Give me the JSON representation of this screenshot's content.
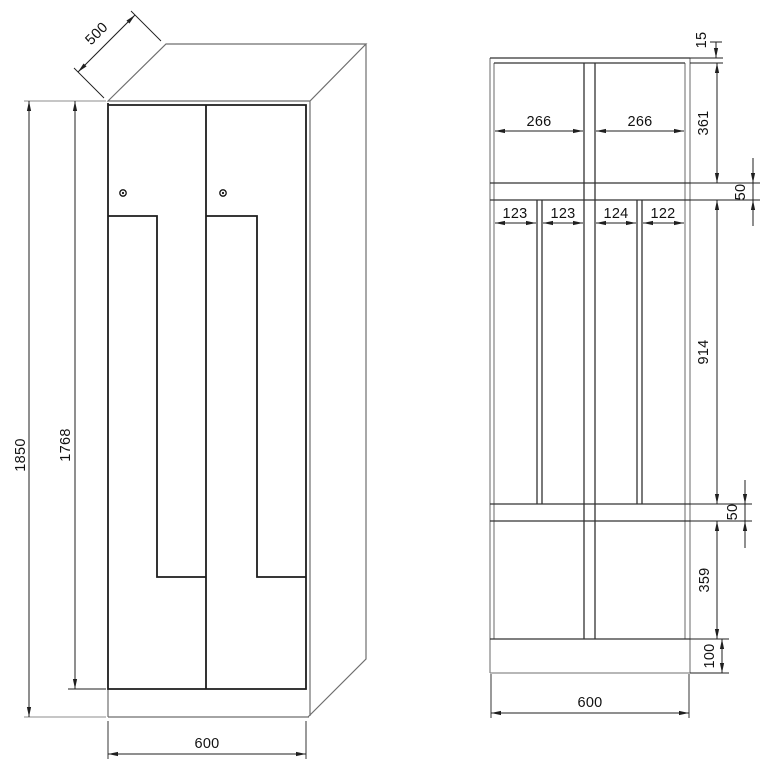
{
  "drawing": {
    "type": "technical dimension drawing of a Z-door locker cabinet",
    "front_view": {
      "depth": "500",
      "total_height": "1850",
      "door_height": "1768",
      "width": "600",
      "lock_count": 2
    },
    "section_view": {
      "top_panel_thickness": "15",
      "top_compartment_height": "361",
      "top_compartment_widths": [
        "266",
        "266"
      ],
      "shelf_gap_top": "50",
      "locker_column_widths": [
        "123",
        "123",
        "124",
        "122"
      ],
      "middle_section_height": "914",
      "shelf_gap_bottom": "50",
      "bottom_compartment_height": "359",
      "plinth_height": "100",
      "width": "600"
    }
  }
}
